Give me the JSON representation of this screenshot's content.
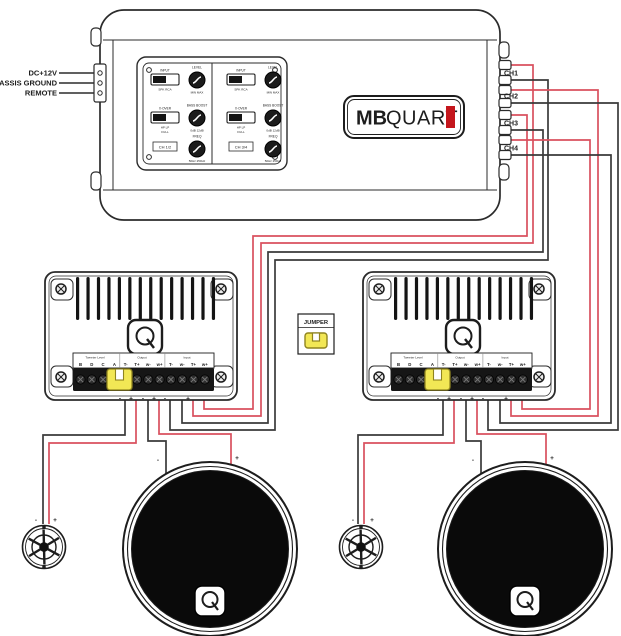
{
  "colors": {
    "red": "#d9505e",
    "black": "#3a3a3a",
    "jumper_yellow": "#f2e755",
    "jumper_stroke": "#8f841f",
    "brand_red": "#c4161c",
    "outline": "#2b2b2b"
  },
  "amplifier": {
    "brand": {
      "bold": "MB",
      "light": "QUART"
    },
    "power_inputs": [
      {
        "label": "DC+12V"
      },
      {
        "label": "CHASSIS GROUND"
      },
      {
        "label": "REMOTE"
      }
    ],
    "channels": [
      {
        "label": "CH1"
      },
      {
        "label": "CH2"
      },
      {
        "label": "CH3"
      },
      {
        "label": "CH4"
      }
    ],
    "panel": {
      "input_label": "INPUT",
      "input_range": "SPK  RCA",
      "level_label": "LEVEL",
      "level_range": "MIN  MAX",
      "xover_label": "X-OVER",
      "xover_range": "HP  LP",
      "xover_range2": "FULL",
      "boost_label": "BASS BOOST",
      "boost_range": "0dB  12dB",
      "freq_label": "FREQ",
      "freq_range": "50Hz  250Hz",
      "badge_left": "CH 1/2",
      "badge_right": "CH 3/4"
    }
  },
  "jumper_legend": {
    "label": "JUMPER"
  },
  "crossover": {
    "terminal_headers": [
      "Tweeter Level",
      "Output",
      "Input"
    ],
    "terminal_labels": [
      "B",
      "D",
      "C",
      "A",
      "T-",
      "T+",
      "w-",
      "w+",
      "T-",
      "w-",
      "T+",
      "w+"
    ],
    "polarity_row": [
      "-",
      "+",
      "-",
      "+",
      "-",
      "+"
    ]
  },
  "polarity": {
    "minus": "-",
    "plus": "+"
  },
  "wiring": [
    {
      "name": "wire-ch1-plus-to-left-xo-tweeter-plus-input",
      "color": "red",
      "points": [
        [
          511,
          65
        ],
        [
          533,
          65
        ],
        [
          533,
          243
        ],
        [
          261,
          243
        ],
        [
          261,
          416
        ],
        [
          193,
          416
        ],
        [
          193,
          392
        ]
      ]
    },
    {
      "name": "wire-ch1-minus-to-left-xo-tweeter-minus-input",
      "color": "black",
      "points": [
        [
          511,
          80
        ],
        [
          548,
          80
        ],
        [
          548,
          260
        ],
        [
          275,
          260
        ],
        [
          275,
          430
        ],
        [
          170,
          430
        ],
        [
          170,
          392
        ]
      ]
    },
    {
      "name": "wire-ch2-plus-to-right-xo-tweeter-plus-input",
      "color": "red",
      "points": [
        [
          511,
          90
        ],
        [
          598,
          90
        ],
        [
          598,
          416
        ],
        [
          511,
          416
        ],
        [
          511,
          392
        ]
      ]
    },
    {
      "name": "wire-ch2-minus-to-right-xo-tweeter-minus-input",
      "color": "black",
      "points": [
        [
          511,
          103
        ],
        [
          618,
          103
        ],
        [
          618,
          430
        ],
        [
          488,
          430
        ],
        [
          488,
          392
        ]
      ]
    },
    {
      "name": "wire-ch3-plus-to-left-xo-woofer-plus-input",
      "color": "red",
      "points": [
        [
          511,
          115
        ],
        [
          527,
          115
        ],
        [
          527,
          236
        ],
        [
          253,
          236
        ],
        [
          253,
          409
        ],
        [
          204,
          409
        ],
        [
          204,
          392
        ]
      ]
    },
    {
      "name": "wire-ch3-minus-to-left-xo-woofer-minus-input",
      "color": "black",
      "points": [
        [
          511,
          130
        ],
        [
          543,
          130
        ],
        [
          543,
          252
        ],
        [
          268,
          252
        ],
        [
          268,
          423
        ],
        [
          182,
          423
        ],
        [
          182,
          392
        ]
      ]
    },
    {
      "name": "wire-ch4-plus-to-right-xo-woofer-plus-input",
      "color": "red",
      "points": [
        [
          511,
          140
        ],
        [
          590,
          140
        ],
        [
          590,
          409
        ],
        [
          522,
          409
        ],
        [
          522,
          392
        ]
      ]
    },
    {
      "name": "wire-ch4-minus-to-right-xo-woofer-minus-input",
      "color": "black",
      "points": [
        [
          511,
          155
        ],
        [
          611,
          155
        ],
        [
          611,
          423
        ],
        [
          500,
          423
        ],
        [
          500,
          392
        ]
      ]
    },
    {
      "name": "wire-left-xo-tweeter-minus-output",
      "color": "black",
      "points": [
        [
          125,
          392
        ],
        [
          125,
          435
        ],
        [
          43,
          435
        ],
        [
          43,
          524
        ]
      ]
    },
    {
      "name": "wire-left-xo-tweeter-plus-output",
      "color": "red",
      "points": [
        [
          136,
          392
        ],
        [
          136,
          443
        ],
        [
          49,
          443
        ],
        [
          49,
          524
        ]
      ]
    },
    {
      "name": "wire-left-xo-woofer-minus-output",
      "color": "black",
      "points": [
        [
          148,
          392
        ],
        [
          148,
          441
        ],
        [
          166,
          441
        ],
        [
          166,
          474
        ]
      ]
    },
    {
      "name": "wire-left-xo-woofer-plus-output",
      "color": "red",
      "points": [
        [
          159,
          392
        ],
        [
          159,
          434
        ],
        [
          231,
          434
        ],
        [
          231,
          465
        ]
      ]
    },
    {
      "name": "wire-right-xo-tweeter-minus-output",
      "color": "black",
      "points": [
        [
          443,
          392
        ],
        [
          443,
          435
        ],
        [
          358,
          435
        ],
        [
          358,
          524
        ]
      ]
    },
    {
      "name": "wire-right-xo-tweeter-plus-output",
      "color": "red",
      "points": [
        [
          454,
          392
        ],
        [
          454,
          443
        ],
        [
          364,
          443
        ],
        [
          364,
          524
        ]
      ]
    },
    {
      "name": "wire-right-xo-woofer-minus-output",
      "color": "black",
      "points": [
        [
          466,
          392
        ],
        [
          466,
          441
        ],
        [
          481,
          441
        ],
        [
          481,
          474
        ]
      ]
    },
    {
      "name": "wire-right-xo-woofer-plus-output",
      "color": "red",
      "points": [
        [
          477,
          392
        ],
        [
          477,
          434
        ],
        [
          546,
          434
        ],
        [
          546,
          465
        ]
      ]
    }
  ]
}
